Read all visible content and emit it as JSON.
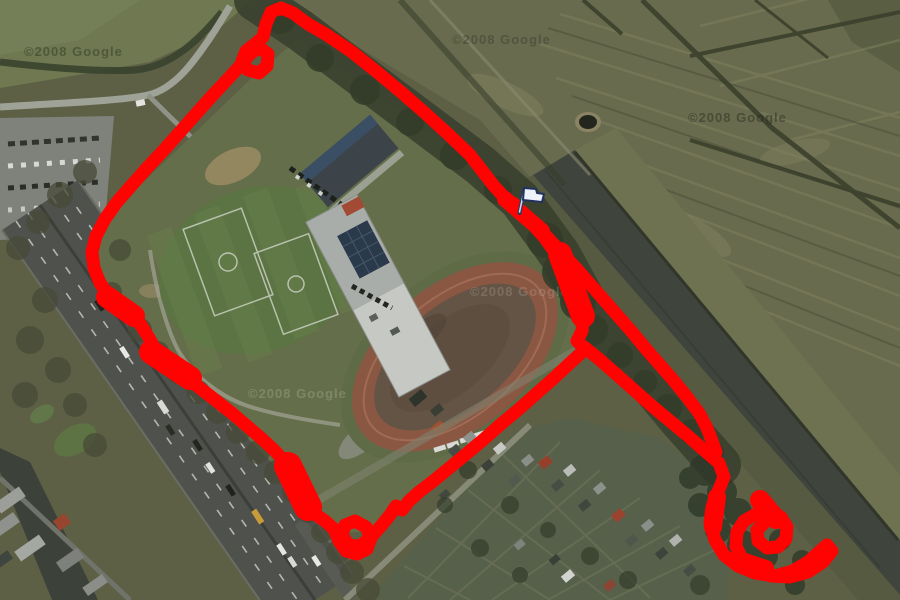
{
  "map": {
    "watermarks": [
      {
        "text": "©2008 Google"
      },
      {
        "text": "©2008 Google"
      },
      {
        "text": "©2008 Google"
      },
      {
        "text": "©2008 Google"
      },
      {
        "text": "©2008 Google"
      }
    ],
    "track": {
      "color": "#fe0302"
    },
    "marker": {
      "kind": "start-flag",
      "fill": "#eef3fa",
      "outline": "#223260",
      "pole_fill": "#cdd8ee"
    }
  }
}
